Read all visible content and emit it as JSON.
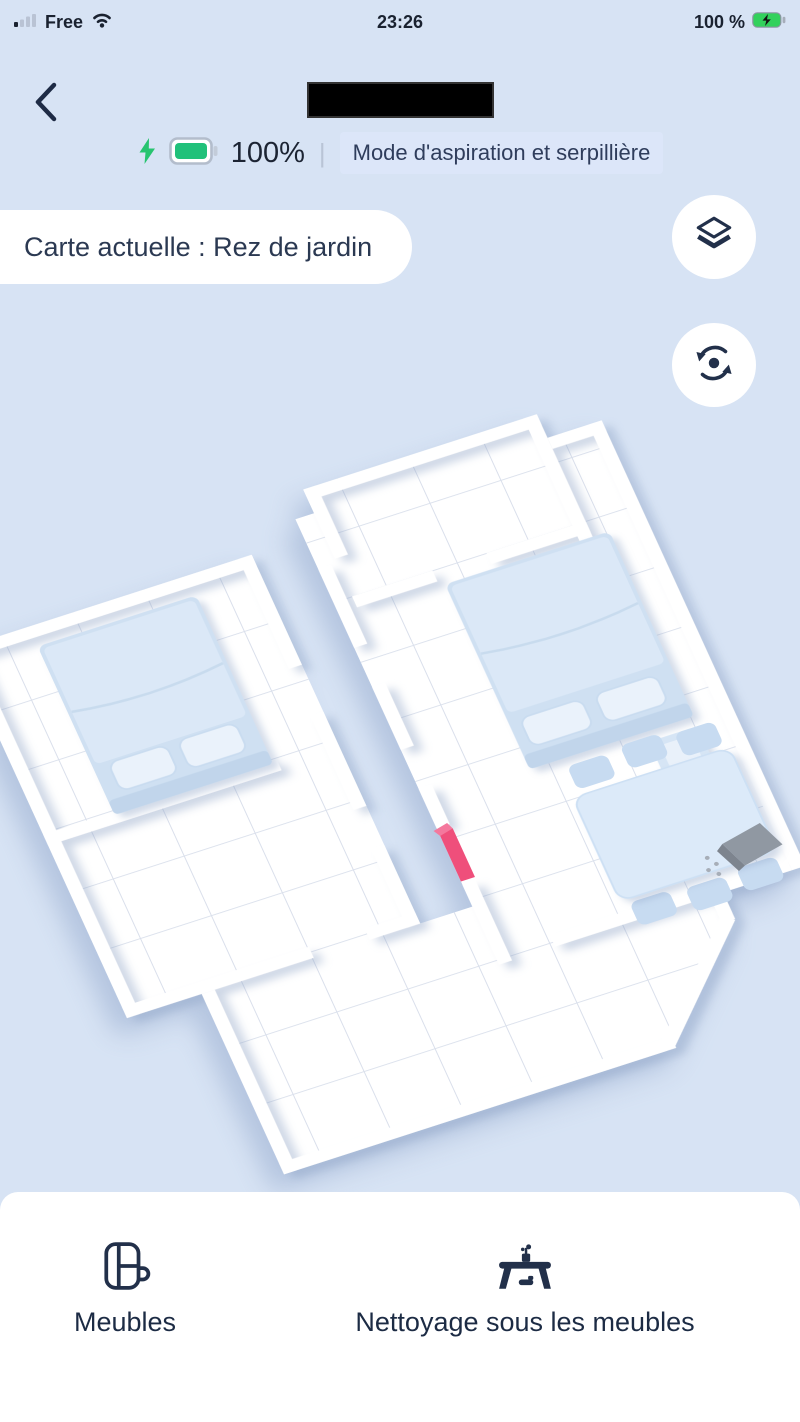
{
  "status_bar": {
    "signal_icon": "cellular-signal-icon",
    "carrier": "Free",
    "wifi_icon": "wifi-icon",
    "time": "23:26",
    "battery_percent": "100 %",
    "battery_icon": "battery-charging-icon"
  },
  "header": {
    "back_icon": "back-chevron-icon",
    "device_name": "",
    "bolt_icon": "charging-bolt-icon",
    "battery_level": "100%",
    "mode_badge": "Mode d'aspiration et serpillière"
  },
  "map": {
    "current_map_pill": "Carte actuelle : Rez de jardin",
    "controls": [
      {
        "icon": "layers-icon"
      },
      {
        "icon": "rotate-icon"
      }
    ],
    "objects": [
      "bed",
      "bed",
      "nightstand",
      "dining-table-with-chairs",
      "charging-dock",
      "door-marker"
    ],
    "colors": {
      "background": "#d7e3f4",
      "wall": "#ffffff",
      "grid_line": "#d9dfeb",
      "furniture_blue": "#cfe0f2",
      "marker_pink": "#ef4f7b",
      "dock_gray": "#9098a2"
    }
  },
  "tab_bar": {
    "items": [
      {
        "icon": "furniture-icon",
        "label": "Meubles"
      },
      {
        "icon": "clean-under-furniture-icon",
        "label": "Nettoyage sous les meubles"
      }
    ]
  },
  "colors": {
    "accent_green": "#2bc873",
    "text_navy": "#1e2b45",
    "badge_bg": "#dce6f9"
  }
}
